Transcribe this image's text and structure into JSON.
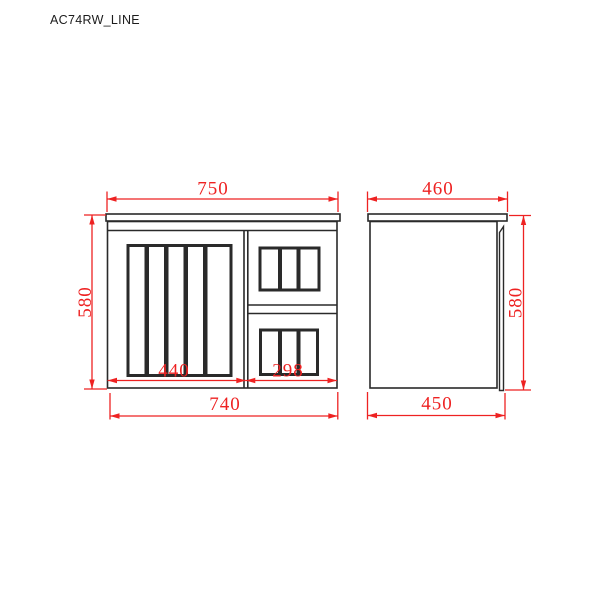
{
  "title": "AC74RW_LINE",
  "colors": {
    "background": "#ffffff",
    "line_ink": "#2a2a2a",
    "dimension_red": "#ee2222"
  },
  "front_view": {
    "dimensions": {
      "top_width": "750",
      "height": "580",
      "door_width": "440",
      "drawer_width": "298",
      "bottom_width": "740"
    }
  },
  "side_view": {
    "dimensions": {
      "top_depth": "460",
      "height": "580",
      "bottom_depth": "450"
    }
  }
}
